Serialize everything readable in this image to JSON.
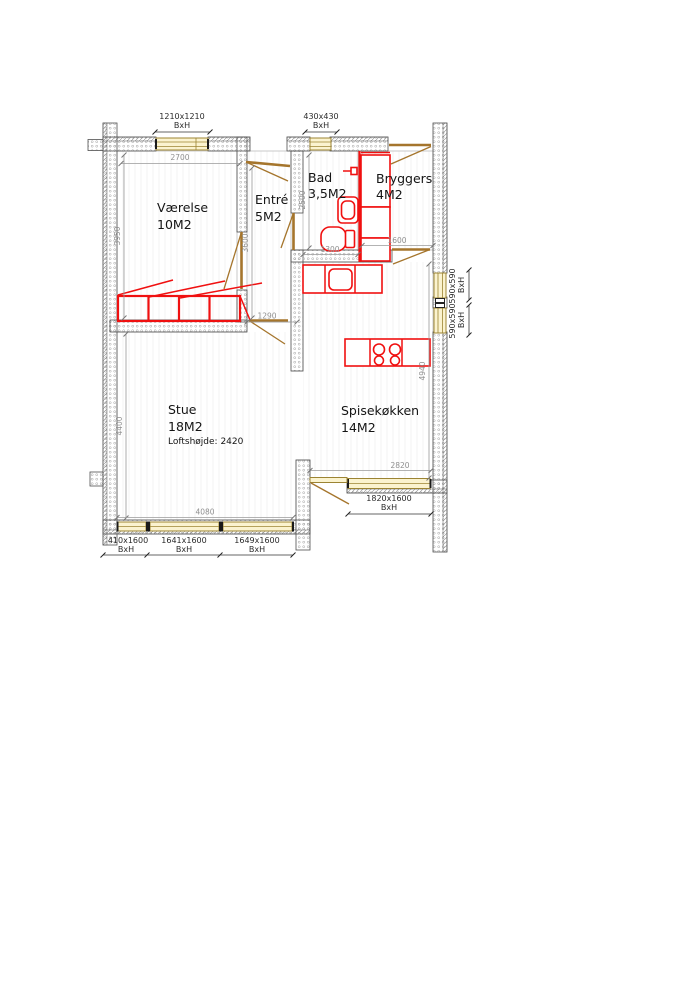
{
  "rooms": [
    {
      "name": "Værelse",
      "area": "10M2"
    },
    {
      "name": "Entré",
      "area": "5M2"
    },
    {
      "name": "Bad",
      "area": "3,5M2"
    },
    {
      "name": "Bryggers",
      "area": "4M2"
    },
    {
      "name": "Stue",
      "area": "18M2",
      "note": "Loftshøjde: 2420"
    },
    {
      "name": "Spisekøkken",
      "area": "14M2"
    }
  ],
  "dimensions": {
    "d2700": "2700",
    "d3950": "3950",
    "d3600": "3600",
    "d2500": "2500",
    "d1300": "1300",
    "d1600": "1600",
    "d1290": "1290",
    "d4400": "4400",
    "d4940": "4940",
    "d4080": "4080",
    "d2820": "2820"
  },
  "windows": [
    {
      "size": "1210x1210",
      "sub": "BxH"
    },
    {
      "size": "430x430",
      "sub": "BxH"
    },
    {
      "size": "590x590",
      "sub": "BxH"
    },
    {
      "size": "590x590",
      "sub": "BxH"
    },
    {
      "size": "410x1600",
      "sub": "BxH"
    },
    {
      "size": "1641x1600",
      "sub": "BxH"
    },
    {
      "size": "1649x1600",
      "sub": "BxH"
    },
    {
      "size": "1820x1600",
      "sub": "BxH"
    }
  ],
  "colors": {
    "fixture_red": "#f01010",
    "wood_tan": "#9c8433",
    "wall_gray": "#4f4f4f",
    "dim_gray": "#8f8f8f"
  }
}
